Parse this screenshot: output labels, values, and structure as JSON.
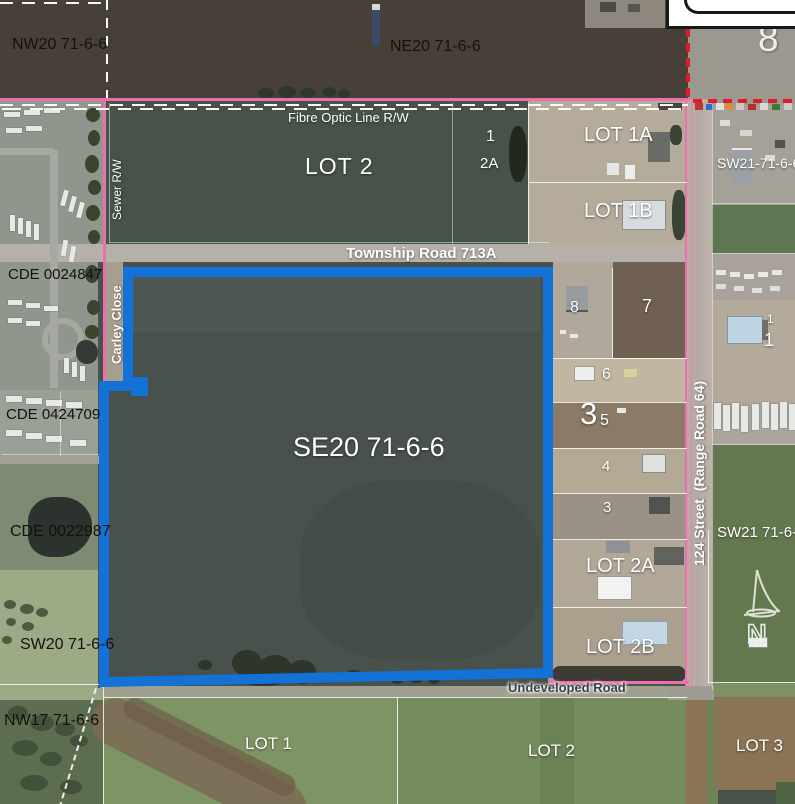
{
  "map": {
    "sections": {
      "nw20": "NW20 71-6-6",
      "ne20": "NE20 71-6-6",
      "sec8": "8",
      "sw21_upper": "SW21-71-6-6",
      "sw21_lower": "SW21 71-6-6",
      "se20": "SE20 71-6-6",
      "sw20": "SW20 71-6-6",
      "nw17": "NW17 71-6-6"
    },
    "roads": {
      "township": "Township Road 713A",
      "street124": "124 Street  (Range Road 64)",
      "undeveloped": "Undeveloped Road",
      "carley": "Carley Close"
    },
    "easements": {
      "fibre": "Fibre Optic Line R/W",
      "sewer": "Sewer R/W"
    },
    "plans": {
      "cde1": "CDE 0024847",
      "cde2": "CDE 0424709",
      "cde3": "CDE 0022987"
    },
    "lots": {
      "lot2_top": "LOT 2",
      "lot1a": "LOT 1A",
      "lot1b": "LOT 1B",
      "lot2a": "LOT 2A",
      "lot2b": "LOT 2B",
      "lot1_s": "LOT 1",
      "lot2_s": "LOT 2",
      "lot3_s": "LOT 3"
    },
    "parcels": {
      "p1": "1",
      "p2a": "2A",
      "n8": "8",
      "n7": "7",
      "n6": "6",
      "n3b": "3",
      "n5": "5",
      "n4": "4",
      "n3": "3",
      "r1a": "1",
      "r1b": "1"
    },
    "north": {
      "label": "N"
    },
    "colors": {
      "parcel_outline_blue": "#1272d8",
      "boundary_pink": "#ee6fae",
      "boundary_red": "#e01b2a"
    }
  }
}
